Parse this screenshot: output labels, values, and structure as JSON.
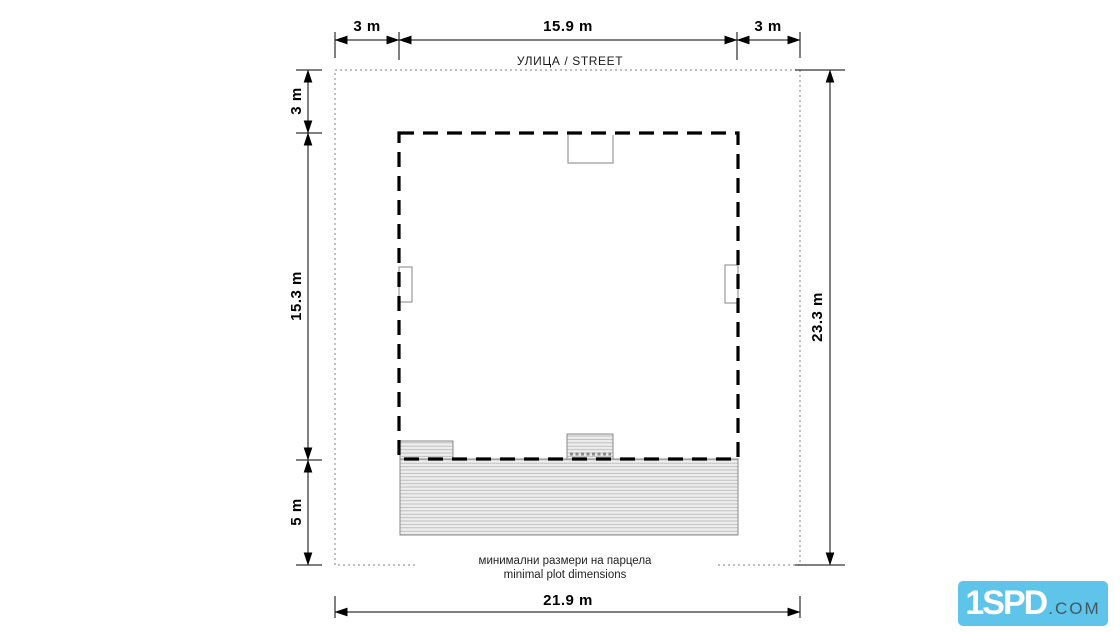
{
  "drawing": {
    "street_label": "УЛИЦА / STREET",
    "caption_line1": "минимални размери на парцела",
    "caption_line2": "minimal plot dimensions"
  },
  "dims": {
    "top": [
      "3 m",
      "15.9 m",
      "3 m"
    ],
    "left": [
      "3 m",
      "15.3 m",
      "5 m"
    ],
    "right": "23.3 m",
    "bottom": "21.9 m"
  },
  "logo": {
    "brand": "1SPD",
    "suffix": ".COM"
  },
  "colors": {
    "outline_black": "#000000",
    "boundary_gray": "#999999",
    "detail_gray": "#8a8a8a",
    "hatch_fill": "#ededed",
    "hatch_line": "#b5b5b5",
    "logo_blue": "#5ec4ea"
  }
}
